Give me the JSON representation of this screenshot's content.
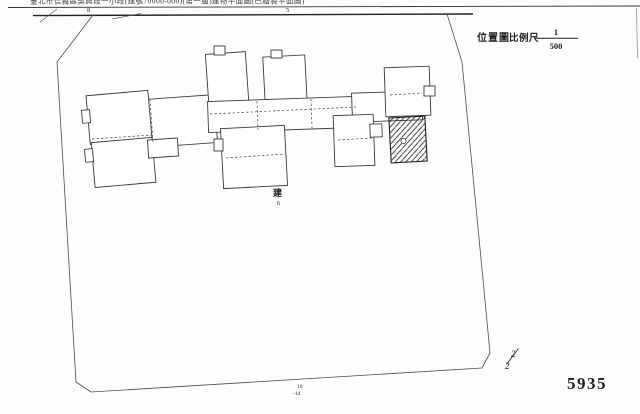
{
  "document": {
    "header_title": "臺北市信義區吳興段一小段(建號70000-000)(第一層)建物平面圖(已繪製平面圖)",
    "road_labels": {
      "left": "8",
      "center": "5"
    },
    "legend": {
      "map_type": "位置圖",
      "scale_label": "比例尺",
      "scale_numerator": "1",
      "scale_denominator": "500"
    },
    "building_mark": {
      "char": "建",
      "number": "6"
    },
    "parcel_label": {
      "line1": "10",
      "line2": "-14"
    },
    "page_fraction": {
      "numerator": "2",
      "denominator": "2"
    },
    "sheet_number": "5935",
    "colors": {
      "ink": "#2e2e2e",
      "paper": "#fdfdfc",
      "faint_line": "#888888"
    }
  }
}
